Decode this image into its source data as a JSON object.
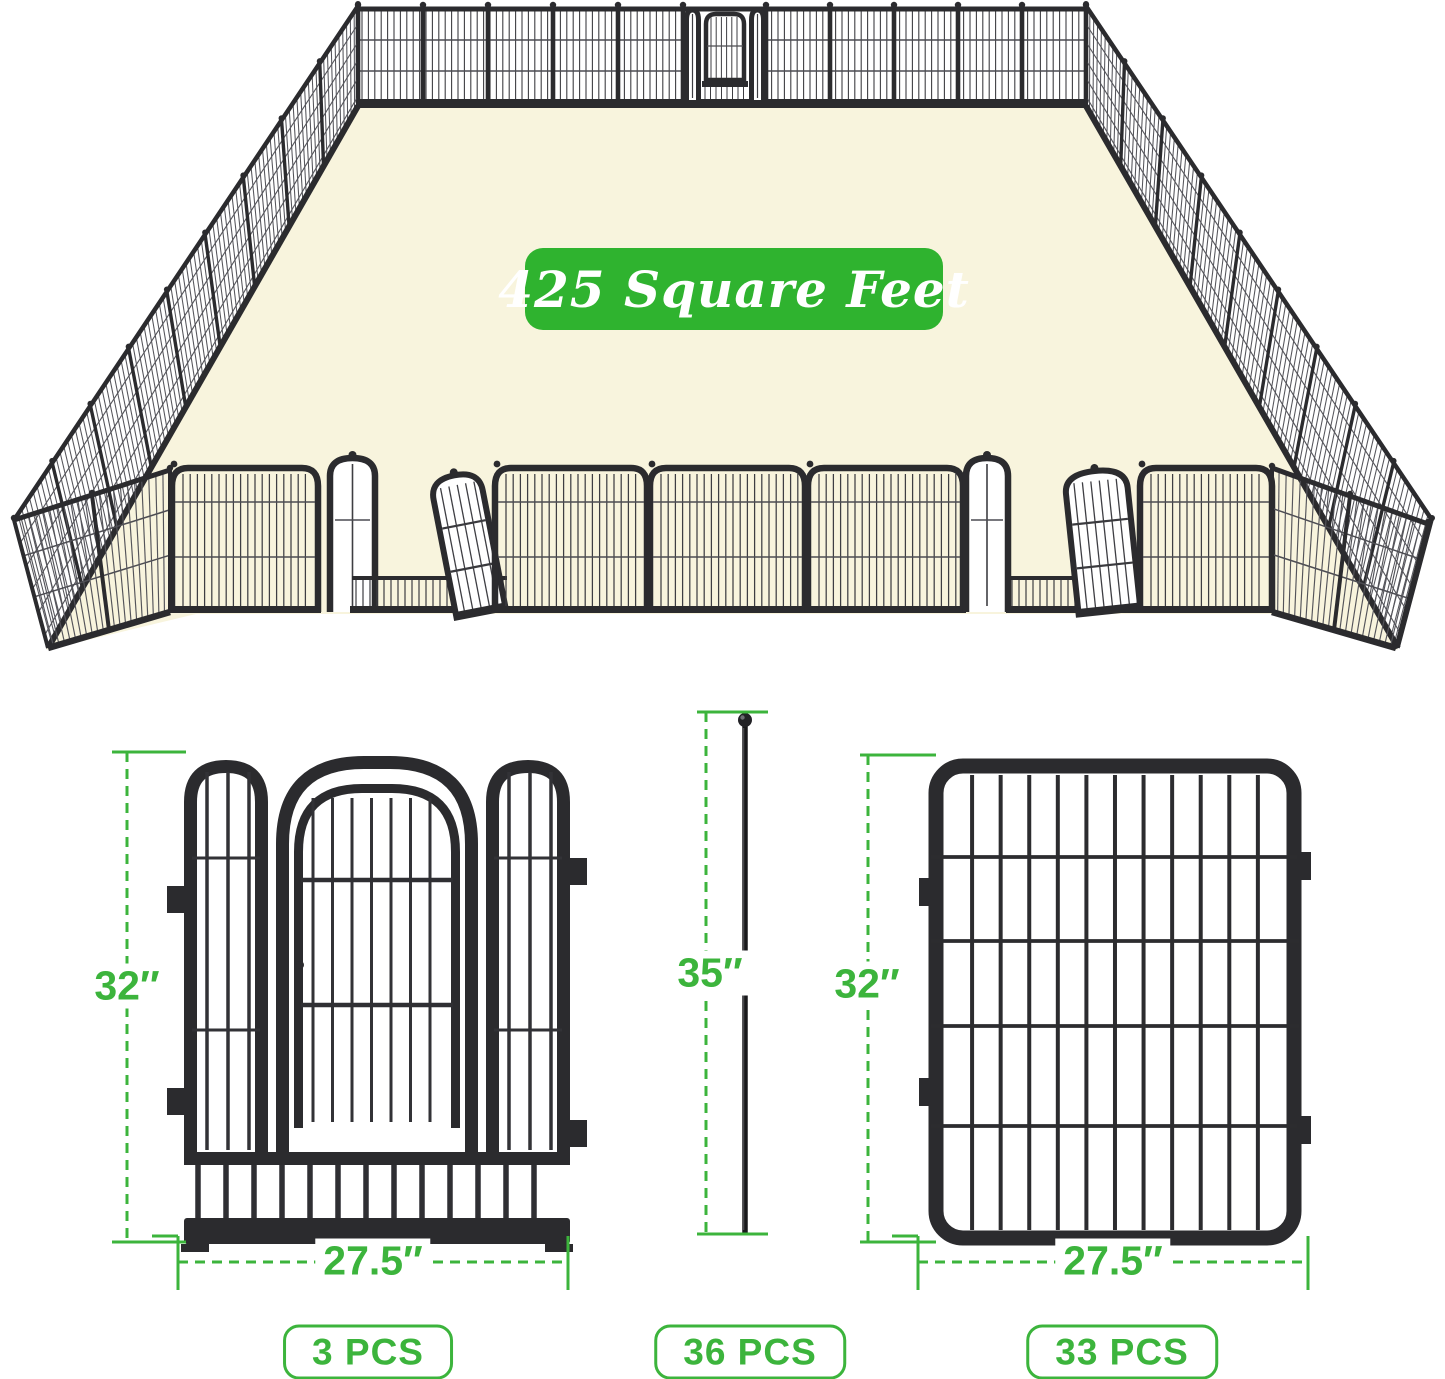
{
  "scene": {
    "area_label": "425 Square Feet"
  },
  "products": [
    {
      "name": "gate-panel",
      "height_label": "32″",
      "width_label": "27.5″",
      "count_label": "3 PCS"
    },
    {
      "name": "ground-stake",
      "height_label": "35″",
      "count_label": "36 PCS"
    },
    {
      "name": "fence-panel",
      "height_label": "32″",
      "width_label": "27.5″",
      "count_label": "33 PCS"
    }
  ],
  "colors": {
    "accent_green": "#2fb32f",
    "dimension_green": "#3cb43c",
    "floor_cream": "#f8f4dd",
    "fence_dark": "#2b2b2e"
  }
}
